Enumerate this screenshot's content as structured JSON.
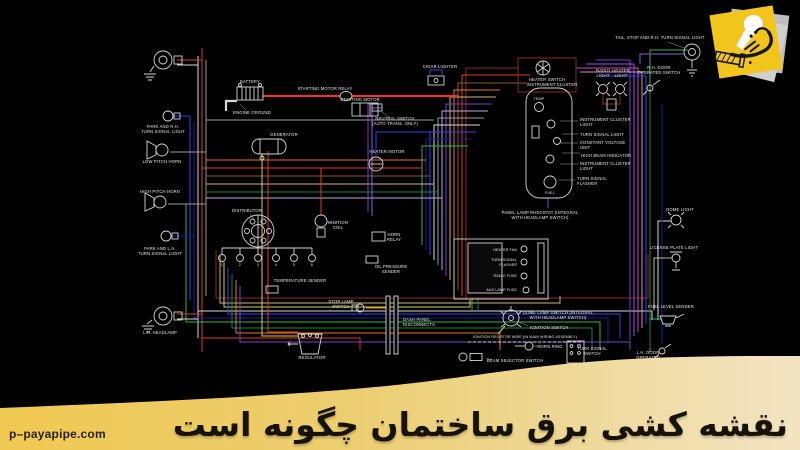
{
  "page": {
    "background": "#000000"
  },
  "banner": {
    "title": "نقشه کشی برق ساختمان چگونه است",
    "bg_left": "#f0c951",
    "bg_mid": "#ecce72",
    "bg_right": "#f2e4c2",
    "text_color": "#171208"
  },
  "watermark": {
    "text": "p–payapipe.com",
    "color": "#26211a"
  },
  "logo": {
    "name": "payapipe sticky-note logo",
    "note_color": "#f2c51d",
    "shadow_color": "#bdbdbd",
    "mic_color": "#ffffff",
    "ink_color": "#161616"
  },
  "diagram": {
    "type": "automotive wiring diagram",
    "wire_colors": {
      "red": "#e03a2a",
      "maroon": "#8a2a22",
      "orange": "#e07820",
      "tan": "#c9b877",
      "yellow": "#d6d23c",
      "green": "#2db84d",
      "dkgreen": "#148844",
      "blue": "#3344ee",
      "navy": "#1d1d99",
      "purple": "#7a3fd0",
      "violet": "#9a55e8",
      "magenta": "#cc44cc",
      "pink": "#e088c8",
      "white": "#d8d8d8",
      "gray": "#9a9a9a",
      "brown": "#8a5a2a",
      "lavender": "#b9a8e8"
    },
    "spark_plug_numbers": [
      "1",
      "2",
      "3",
      "4",
      "5",
      "6"
    ],
    "labels": {
      "battery": "BATTERY",
      "engine_ground": "ENGINE GROUND",
      "starting_motor_relay": "STARTING MOTOR RELAY",
      "starting_motor": "STARTING MOTOR",
      "neutral_switch": [
        "NEUTRAL SWITCH",
        "(AUTO TRANS. ONLY)"
      ],
      "heater_motor": "HEATER MOTOR",
      "generator": "GENERATOR",
      "park_rh_turn_signal": [
        "PARK AND R.H.",
        "TURN SIGNAL LIGHT"
      ],
      "low_pitch_horn": "LOW PITCH HORN",
      "high_pitch_horn": "HIGH PITCH HORN",
      "park_lh_turn_signal": [
        "PARK AND L.H.",
        "TURN SIGNAL LIGHT"
      ],
      "lh_headlamp": "L.H. HEADLAMP",
      "distributor": "DISTRIBUTOR",
      "ignition_coil": [
        "IGNITION",
        "COIL"
      ],
      "temperature_sender": "TEMPERATURE SENDER",
      "oil_pressure_sender": [
        "OIL PRESSURE",
        "SENDER"
      ],
      "horn_relay": [
        "HORN",
        "RELAY"
      ],
      "stop_lamp_switch": [
        "STOP LAMP",
        "SWITCH"
      ],
      "regulator": "REGULATOR",
      "dash_panel_disconnects": [
        "DASH PANEL",
        "DISCONNECTS"
      ],
      "cigar_lighter": "CIGAR LIGHTER",
      "heater_switch": "HEATER SWITCH",
      "instrument_cluster": "INSTRUMENT CLUSTER",
      "temp_gauge": "TEMP",
      "fuel_gauge": "FUEL",
      "instrument_cluster_light_1": [
        "INSTRUMENT CLUSTER",
        "LIGHT"
      ],
      "turn_signal_light": "TURN SIGNAL LIGHT",
      "constant_voltage_unit": [
        "CONSTANT VOLTAGE",
        "UNIT"
      ],
      "high_beam_indicator": "HIGH BEAM INDICATOR",
      "instrument_cluster_light_2": [
        "INSTRUMENT CLUSTER",
        "LIGHT"
      ],
      "turn_signal_flasher": [
        "TURN SIGNAL",
        "FLASHER"
      ],
      "radio_light": [
        "RADIO",
        "LIGHT"
      ],
      "heater_light": [
        "HEATER",
        "LIGHT"
      ],
      "tail_stop_light": "TAIL, STOP AND R.H. TURN SIGNAL LIGHT",
      "rh_door_switch": [
        "R.H. DOOR",
        "OPERATED SWITCH"
      ],
      "dome_light": "DOME LIGHT",
      "license_plate_light": "LICENSE PLATE LIGHT",
      "fuel_level_sender": "FUEL LEVEL SENDER",
      "panel_lamp_rheostat": [
        "PANEL LAMP RHEOSTAT (INTEGRAL",
        "WITH HEADLAMP SWITCH)"
      ],
      "fuse_heater_fan": "HEATER FAN",
      "fuse_turn_signal": [
        "TURN SIGNAL",
        "FLASHER"
      ],
      "fuse_radio": "RADIO FUSE",
      "fuse_aux_lamp": "AUX LAMP FUSE",
      "dome_lamp_switch": [
        "DOME LAMP SWITCH (INTEGRAL",
        "WITH HEADLAMP SWITCH)"
      ],
      "ignition_switch": "IGNITION SWITCH",
      "ignition_resistor": "IGNITION RESISTOR WIRE (IN MAIN WIRING ASSEMBLY)",
      "horn_ring": "HORN RING",
      "turn_signal_switch": [
        "TURN SIGNAL",
        "SWITCH"
      ],
      "beam_selector_switch": "BEAM SELECTOR SWITCH",
      "lh_door_switch": [
        "L.H. DOOR",
        "OPERATED",
        "SWITCH"
      ]
    }
  }
}
